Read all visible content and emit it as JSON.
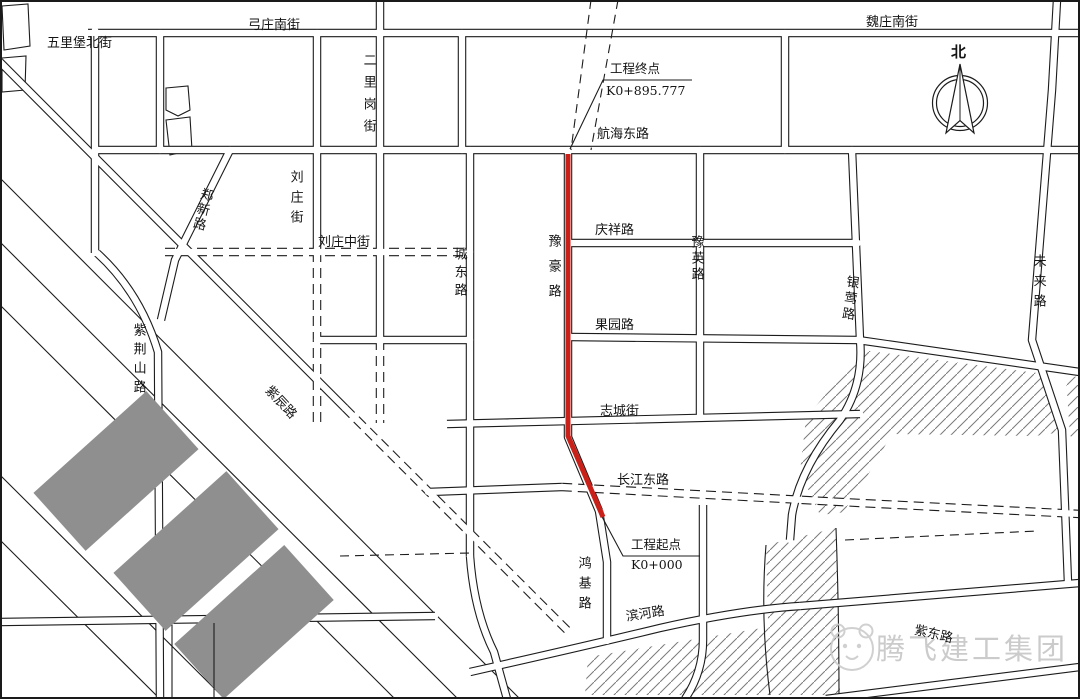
{
  "map": {
    "compass_label": "北",
    "route": {
      "name": "豫豪路",
      "color": "#c9211a",
      "end_annotation": {
        "title": "工程终点",
        "chainage": "K0+895.777"
      },
      "start_annotation": {
        "title": "工程起点",
        "chainage": "K0+000"
      }
    },
    "street_labels": {
      "wulibao_north": "五里堡北街",
      "gongzhuang_south": "弓庄南街",
      "weizhuang_south": "魏庄南街",
      "erligang": "二里岗街",
      "zhengxin": "郑新路",
      "liuzhuang": "刘庄街",
      "liuzhuang_middle": "刘庄中街",
      "hanghai_east": "航海东路",
      "chengdong": "城东路",
      "yuhao": "豫豪路",
      "qingxiang": "庆祥路",
      "yuying": "豫英路",
      "guoyuan": "果园路",
      "yinying": "银莺路",
      "weilai": "未来路",
      "zijinshan": "紫荆山路",
      "zichen": "紫辰路",
      "zhicheng": "志城街",
      "changjiang_east": "长江东路",
      "hongji": "鸿基路",
      "binhe": "滨河路",
      "zidong": "紫东路"
    },
    "watermark": {
      "text": "腾飞建工集团",
      "icon": "bear-face",
      "color": "#cbcbcb"
    },
    "legend_colors": {
      "route_red": "#c9211a",
      "block_gray": "#8f8f8f"
    }
  }
}
